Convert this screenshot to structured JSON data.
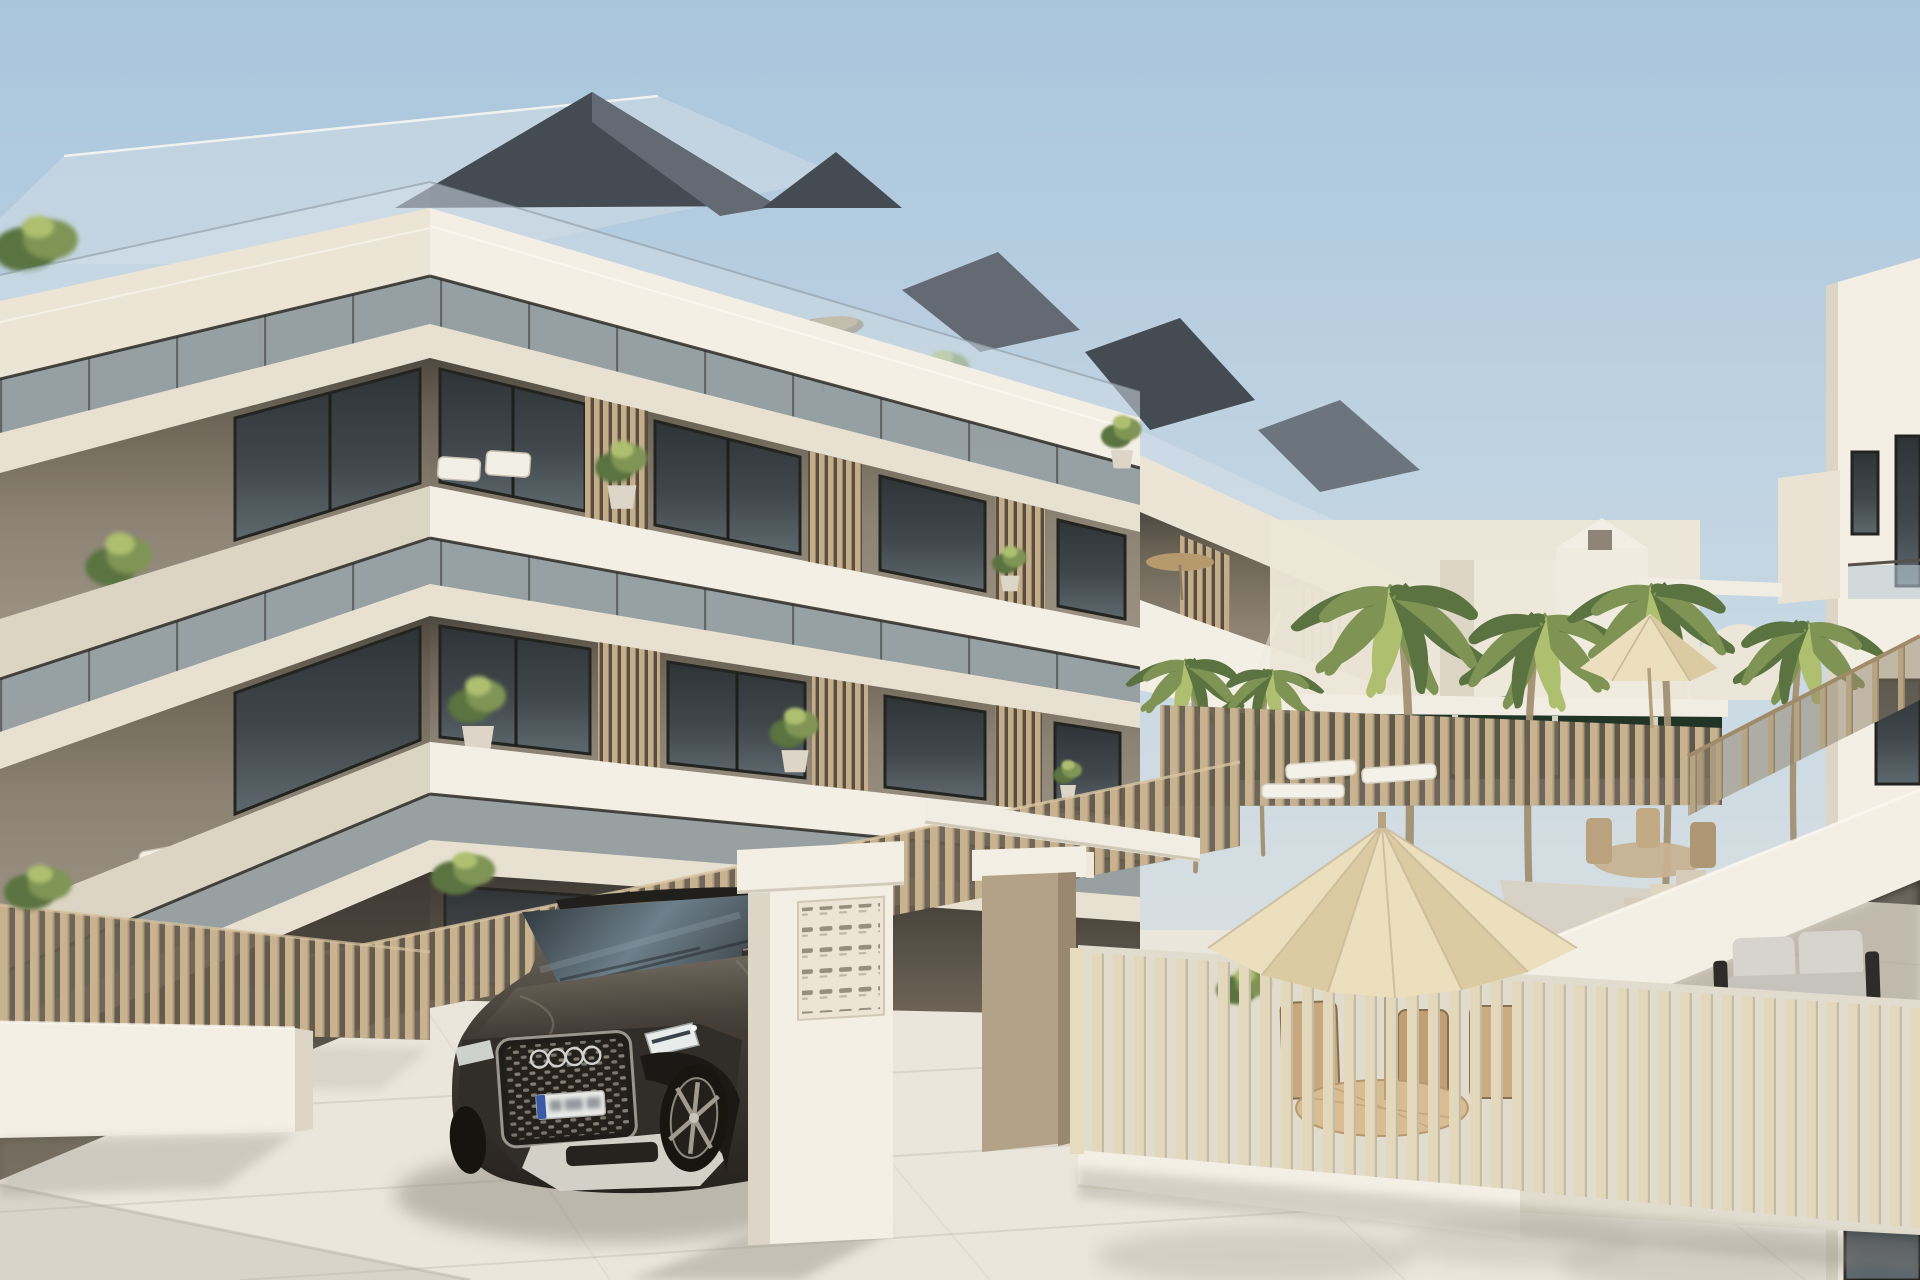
{
  "scene": {
    "title": "Architectural rendering of a modern three-storey apartment complex with pool terrace",
    "description": "Photorealistic 3D render of a new-build cream and taupe apartment building with stacked white balcony bands, glass balustrades and wooden slat privacy screens. A dark Audi SUV is parked at the entrance gate beside a white mailbox pillar. Beige slatted fences enclose a patio with a cream parasol and wicker dining set. Behind, a pool deck with tall palm trees, a dark hedge, white pergola beams and sun loungers leads to a white neighbouring building with an external staircase and a grey outdoor sofa, under a clear pale-blue sky.",
    "type": "architectural-render",
    "weather": "sunny, clear sky",
    "objects": [
      {
        "name": "apartment-building",
        "description": "three-storey modern block, white fascia bands, taupe recessed walls"
      },
      {
        "name": "roof-terrace",
        "description": "glass railing, potted plants, dark beige tilted parasol, grey pitched roof volumes"
      },
      {
        "name": "glass-balustrades",
        "description": "translucent railing strips along every balcony band"
      },
      {
        "name": "slatted-privacy-screens",
        "description": "vertical wooden slat dividers between balconies"
      },
      {
        "name": "balcony-plants",
        "description": "potted green trees and shrubs on balconies"
      },
      {
        "name": "balcony-furniture",
        "description": "white outdoor lounge chairs on corner balconies"
      },
      {
        "name": "suv-car",
        "description": "dark grey-brown Audi SUV parked at the gate, chrome four-ring grille"
      },
      {
        "name": "license-plate",
        "visible": true,
        "legible": false
      },
      {
        "name": "mailbox-pillar",
        "description": "white gate pillar with grid of letterbox slots"
      },
      {
        "name": "entrance-gate",
        "description": "white lintel beam, taupe pillar with white cap, tall beige slat screen"
      },
      {
        "name": "garden-fence",
        "description": "beige vertical-slat fence on low white wall along the street"
      },
      {
        "name": "patio-fence",
        "description": "light cream slatted fence enclosing front patio"
      },
      {
        "name": "patio-umbrella",
        "description": "large cream market parasol over wicker dining set"
      },
      {
        "name": "patio-dining-set",
        "description": "round rattan table with slatted wooden chairs"
      },
      {
        "name": "pool-area",
        "description": "palm trees, dark green hedge, white pergola beams, white sun loungers"
      },
      {
        "name": "palm-trees",
        "description": "six curved-trunk palms of varying height"
      },
      {
        "name": "far-umbrella",
        "description": "small cream parasol with table set on far pool deck"
      },
      {
        "name": "rooftop-parasol-far-wing",
        "description": "small tan parasol on lower terrace of far wing"
      },
      {
        "name": "background-houses",
        "description": "distant white low-rise houses, one gabled with tiny window, one arched"
      },
      {
        "name": "right-building",
        "description": "tall white neighbouring building with dark windows"
      },
      {
        "name": "external-staircase",
        "description": "white solid parapet stair with beige slat railing"
      },
      {
        "name": "outdoor-sofa",
        "description": "light grey two-seat sofa with black frame under the building"
      },
      {
        "name": "pavement",
        "description": "large-format light stone tiles with soft shadows"
      },
      {
        "name": "street",
        "description": "grey paved road strip in bottom-left corner"
      }
    ]
  },
  "palette": {
    "sky_top": "#a9c5dc",
    "sky_mid": "#c8d8e4",
    "sky_horizon": "#e9e7de",
    "fascia_bright": "#f4efe4",
    "fascia_cream": "#ece5d6",
    "fascia_shade": "#ddd5c4",
    "slab_tone": "#e8e1d1",
    "wall_taupe": "#8e8577",
    "wall_deep": "#4f4840",
    "window_frame": "#232320",
    "balustrade_glass": "#b9cad3",
    "rail_dark": "#2e2c27",
    "screen_slat": "#c5ad8a",
    "screen_gap": "#574e41",
    "fence_beige": "#c9b28f",
    "fence_cream": "#e3d7bc",
    "fence_backdrop": "#655c4e",
    "hedge_green": "#213527",
    "palm_green": "#7f9454",
    "palm_dark": "#5a7340",
    "palm_light": "#aebf6f",
    "trunk_brown": "#a29072",
    "pavement": "#ebe6dc",
    "pavement_shade": "#d8d2c6",
    "street_gray": "#d9d4ca",
    "white_wall": "#f4efe5",
    "white_shade": "#ddd6c6",
    "umbrella_cream": "#ecdfbe",
    "umbrella_shade": "#dccba2",
    "parasol_tan": "#b69a6e",
    "roof_dark": "#454b53",
    "roof_mid": "#636a73",
    "glass_slope": "#c6d6e3",
    "car_body": "#433d36",
    "car_dark": "#26221e",
    "car_light": "#7c756a",
    "car_glass": "#3e464c",
    "chrome_silver": "#cfd2d0",
    "sofa_light": "#d7d4cd",
    "plate_blue": "#3b5ba8",
    "shadow_warm": "#8f897c"
  }
}
